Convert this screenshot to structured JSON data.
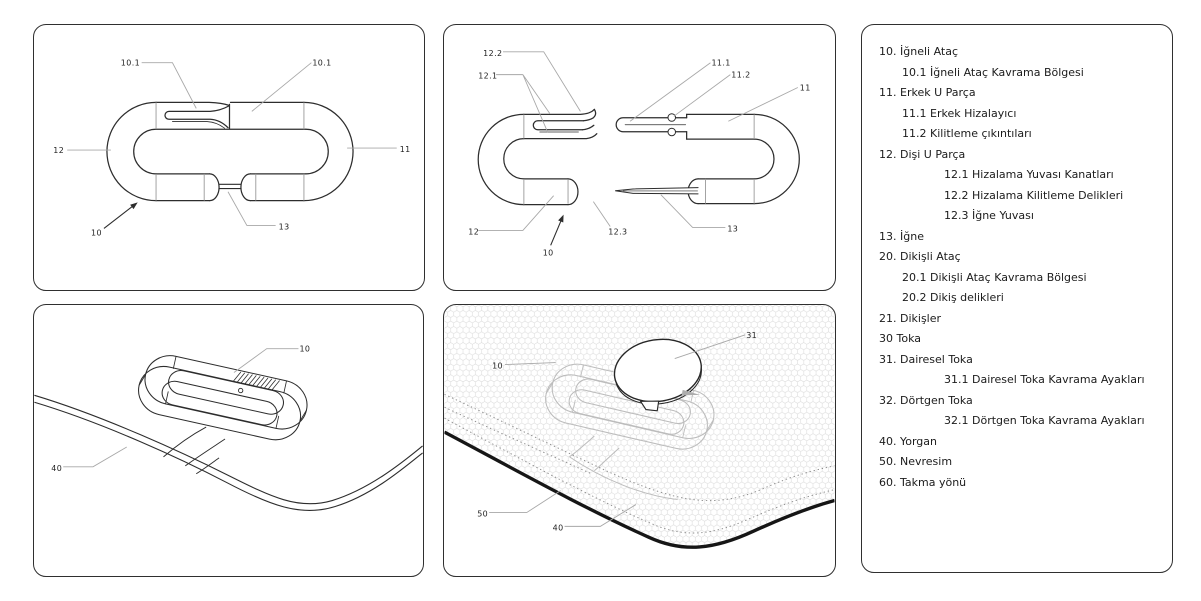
{
  "legend": {
    "items": [
      {
        "text": "10. İğneli Ataç",
        "indent": 0
      },
      {
        "text": "10.1 İğneli Ataç Kavrama Bölgesi",
        "indent": 1
      },
      {
        "text": "11. Erkek U Parça",
        "indent": 0
      },
      {
        "text": "11.1 Erkek Hizalayıcı",
        "indent": 1
      },
      {
        "text": "11.2 Kilitleme çıkıntıları",
        "indent": 1
      },
      {
        "text": "12. Dişi U Parça",
        "indent": 0
      },
      {
        "text": "12.1 Hizalama Yuvası Kanatları",
        "indent": 2
      },
      {
        "text": "12.2 Hizalama Kilitleme Delikleri",
        "indent": 2
      },
      {
        "text": "12.3 İğne Yuvası",
        "indent": 2
      },
      {
        "text": "13. İğne",
        "indent": 0
      },
      {
        "text": "20. Dikişli Ataç",
        "indent": 0
      },
      {
        "text": "20.1 Dikişli Ataç Kavrama Bölgesi",
        "indent": 1
      },
      {
        "text": "20.2 Dikiş delikleri",
        "indent": 1
      },
      {
        "text": "21. Dikişler",
        "indent": 0
      },
      {
        "text": "30 Toka",
        "indent": 0
      },
      {
        "text": "31. Dairesel Toka",
        "indent": 0
      },
      {
        "text": "31.1 Dairesel Toka Kavrama Ayakları",
        "indent": 2
      },
      {
        "text": "32. Dörtgen Toka",
        "indent": 0
      },
      {
        "text": "32.1 Dörtgen Toka Kavrama Ayakları",
        "indent": 2
      },
      {
        "text": "40. Yorgan",
        "indent": 0
      },
      {
        "text": "50. Nevresim",
        "indent": 0
      },
      {
        "text": "60. Takma yönü",
        "indent": 0
      }
    ]
  },
  "figures": {
    "fig1": {
      "labels": {
        "l10_1_left": "10.1",
        "l10_1_right": "10.1",
        "l12": "12",
        "l11": "11",
        "l10": "10",
        "l13": "13"
      }
    },
    "fig2": {
      "labels": {
        "l12_2": "12.2",
        "l12_1": "12.1",
        "l11_1": "11.1",
        "l11_2": "11.2",
        "l11": "11",
        "l12": "12",
        "l12_3": "12.3",
        "l10": "10",
        "l13": "13"
      }
    },
    "fig3": {
      "labels": {
        "l10": "10",
        "l40": "40"
      }
    },
    "fig4": {
      "labels": {
        "l31": "31",
        "l10": "10",
        "l50": "50",
        "l40": "40"
      }
    }
  },
  "colors": {
    "ink": "#2d2d2d",
    "divider": "#999999",
    "leader": "#a8a8a8",
    "label_text": "#1f1f1f",
    "hex_pattern": "#dadada",
    "faint_clip": "#bcbcbc",
    "duvet_edge": "#161616"
  }
}
